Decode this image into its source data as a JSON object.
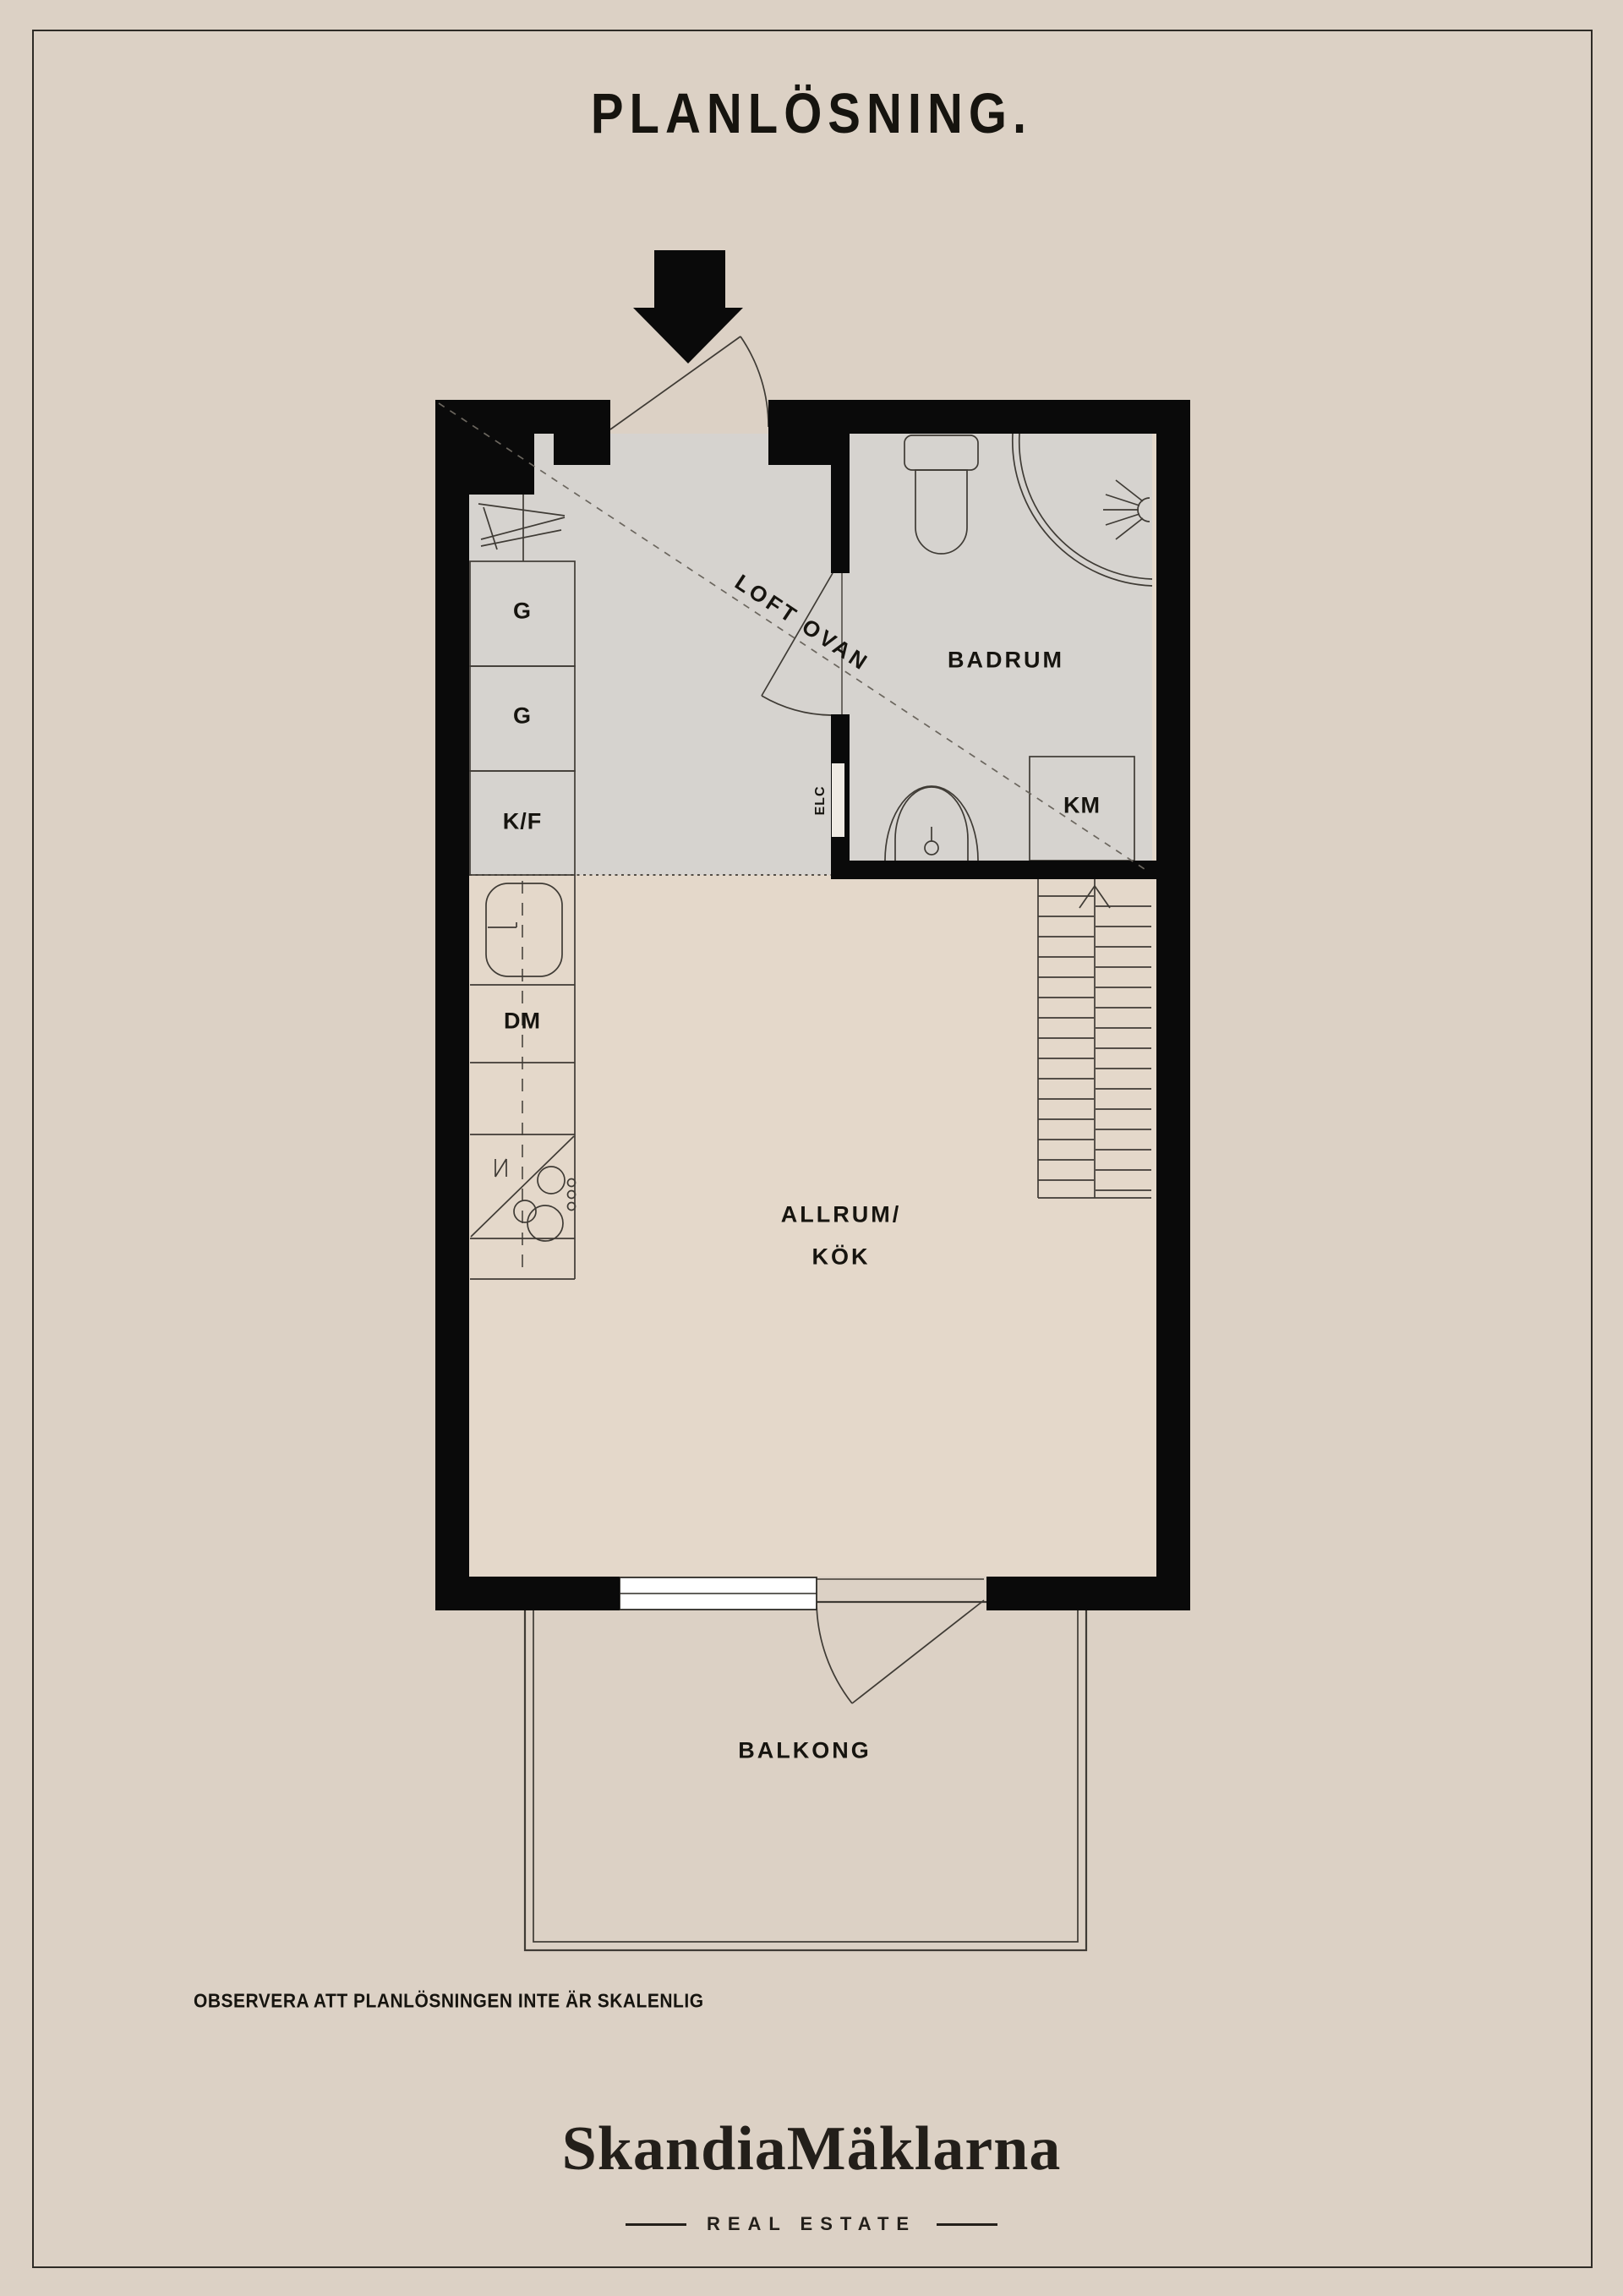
{
  "page": {
    "title": "PLANLÖSNING.",
    "note": "OBSERVERA ATT PLANLÖSNINGEN INTE ÄR SKALENLIG"
  },
  "brand": {
    "name": "SkandiaMäklarna",
    "tagline": "REAL ESTATE"
  },
  "plan": {
    "rooms": {
      "loft": "LOFT OVAN",
      "bathroom": "BADRUM",
      "living_line1": "ALLRUM/",
      "living_line2": "KÖK",
      "balcony": "BALKONG"
    },
    "fixtures": {
      "cabinet1": "G",
      "cabinet2": "G",
      "fridge_freezer": "K/F",
      "dishwasher": "DM",
      "washing_machine": "KM",
      "electrical": "ELC"
    },
    "icons": [
      "entrance-arrow-icon",
      "stairs-icon",
      "toilet-icon",
      "shower-icon",
      "sink-icon",
      "kitchen-sink-icon",
      "stove-icon",
      "wardrobe-icon"
    ]
  },
  "colors": {
    "background": "#dcd1c5",
    "floor_gray": "#d6d3cf",
    "floor_beige": "#e4d8ca",
    "wall": "#0a0a0a",
    "line": "#3f3b35",
    "text": "#16140f"
  }
}
